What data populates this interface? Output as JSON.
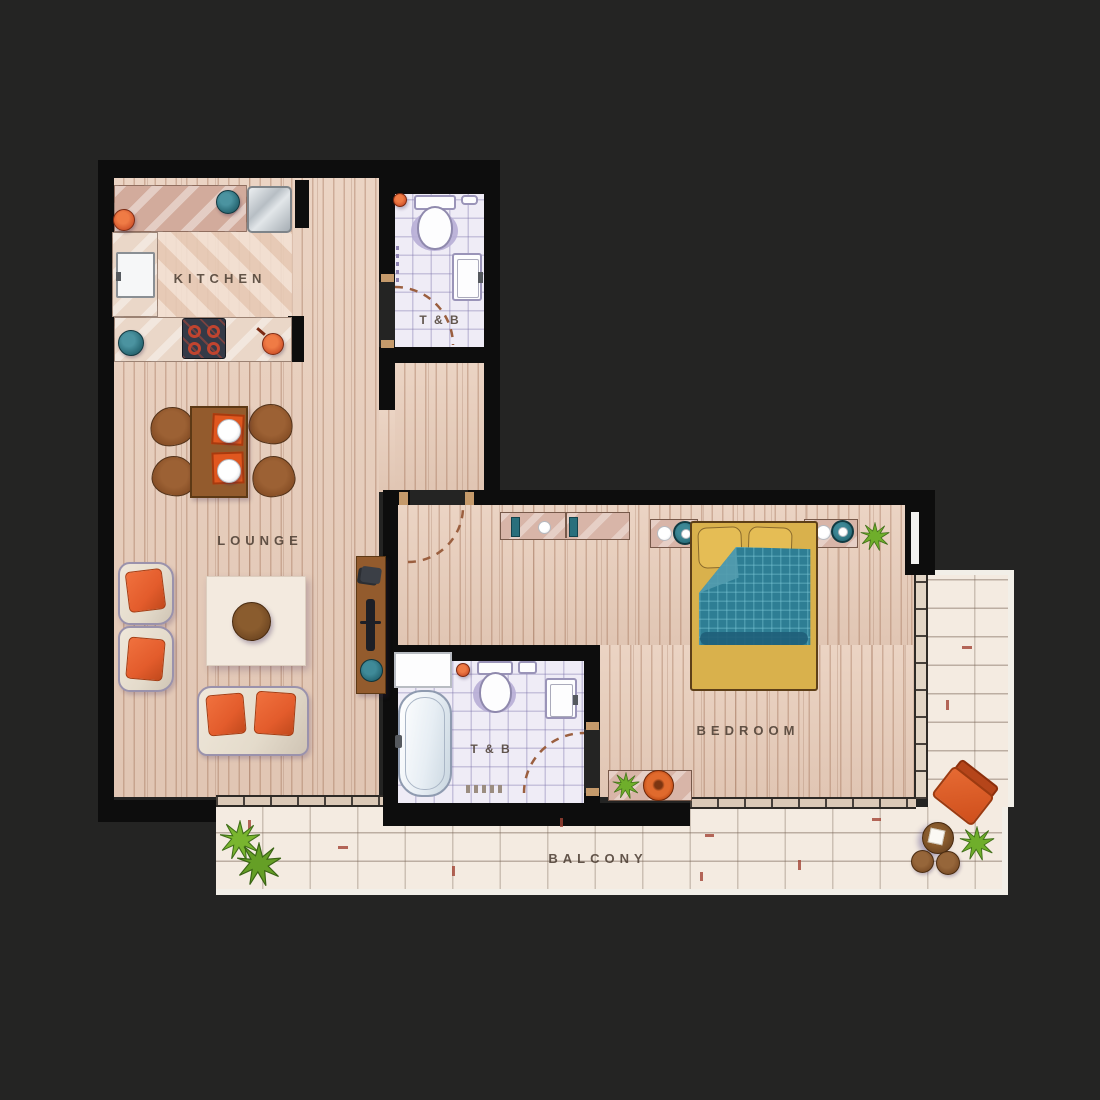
{
  "title": "One-bedroom apartment floor plan",
  "rooms": {
    "kitchen": {
      "label": "KITCHEN"
    },
    "lounge": {
      "label": "LOUNGE"
    },
    "bath1": {
      "label": "T & B"
    },
    "bath2": {
      "label": "T & B"
    },
    "bedroom": {
      "label": "BEDROOM"
    },
    "balcony": {
      "label": "BALCONY"
    }
  },
  "palette": {
    "background": "#242423",
    "wall": "#0d0d0d",
    "wood_floor": "#e9cfbd",
    "bath_tile": "#efecf6",
    "balcony_tile": "#f4ebe1",
    "counter_pink": "#d8b5a8",
    "accent_orange": "#e0571f",
    "accent_teal": "#2d6e7a",
    "bed_spread": "#d9b14c",
    "bed_blanket": "#2e7e94",
    "furniture_wood": "#935b2d",
    "label_text": "#4a3c31",
    "plant_green": "#6fae2b"
  },
  "furniture": {
    "kitchen": [
      "upper-counter",
      "steel-appliance",
      "refrigerator",
      "lower-counter",
      "cooktop",
      "pots-and-pans"
    ],
    "bath1": [
      "toilet",
      "washbasin",
      "door-swing"
    ],
    "lounge": [
      "dining-table",
      "dining-chairs",
      "placemats-with-plates",
      "armchairs",
      "sofa",
      "rug",
      "coffee-table",
      "tv-console"
    ],
    "bath2": [
      "washer-counter",
      "bathtub",
      "toilet",
      "washbasin",
      "bath-mat",
      "door-swing"
    ],
    "bedroom": [
      "dresser",
      "nightstands",
      "table-lamps",
      "double-bed",
      "pillows",
      "duvet",
      "bench",
      "plant"
    ],
    "balcony": [
      "lounge-chair",
      "round-table",
      "stools",
      "plants"
    ]
  }
}
